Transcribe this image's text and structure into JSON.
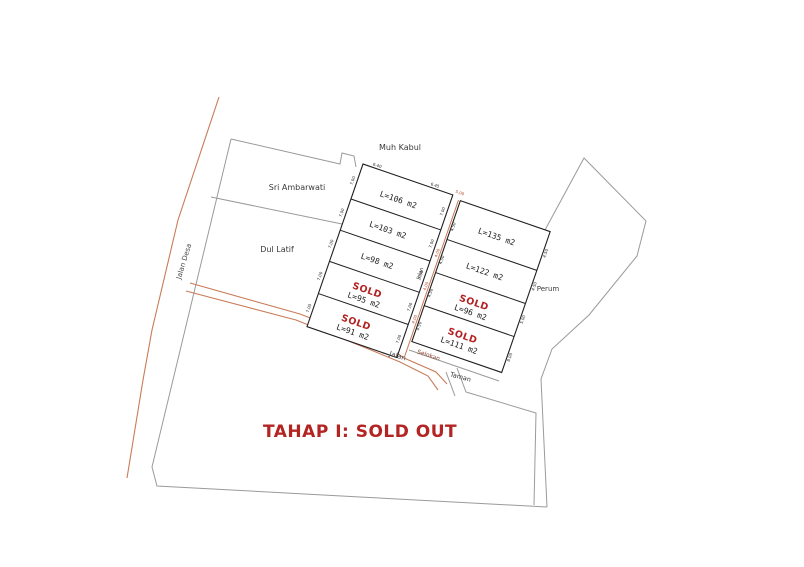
{
  "title": "TAHAP I: SOLD OUT",
  "neighbors": {
    "north": "Muh Kabul",
    "northwest": "Sri Ambarwati",
    "west": "Dul Latif",
    "east": "Perum"
  },
  "roads": {
    "village_road": "Jalan Desa",
    "access_road": "Jalan",
    "inner_road": "Jalan",
    "drain": "Selokan",
    "park": "Taman"
  },
  "sold_label": "SOLD",
  "plots": {
    "left_column": [
      {
        "area": "L=106 m2",
        "sold": false
      },
      {
        "area": "L=103 m2",
        "sold": false
      },
      {
        "area": "L=98 m2",
        "sold": false
      },
      {
        "area": "L=95 m2",
        "sold": true
      },
      {
        "area": "L=91 m2",
        "sold": true
      }
    ],
    "right_column": [
      {
        "area": "L=135 m2",
        "sold": false
      },
      {
        "area": "L=122 m2",
        "sold": false
      },
      {
        "area": "L=96 m2",
        "sold": true
      },
      {
        "area": "L=111 m2",
        "sold": true
      }
    ]
  },
  "dims": {
    "w400": "4.00",
    "w450": "4.50",
    "w500": "5.00",
    "w640": "6.40",
    "w645": "6.45",
    "w700": "7.00",
    "w800": "8.00"
  },
  "colors": {
    "sold_red": "#b32222",
    "title_red": "#b32423",
    "road_orange": "#c97b58",
    "drain_red": "#8a4535",
    "boundary_gray": "#9a9a9a",
    "line_black": "#1f1f1f"
  }
}
